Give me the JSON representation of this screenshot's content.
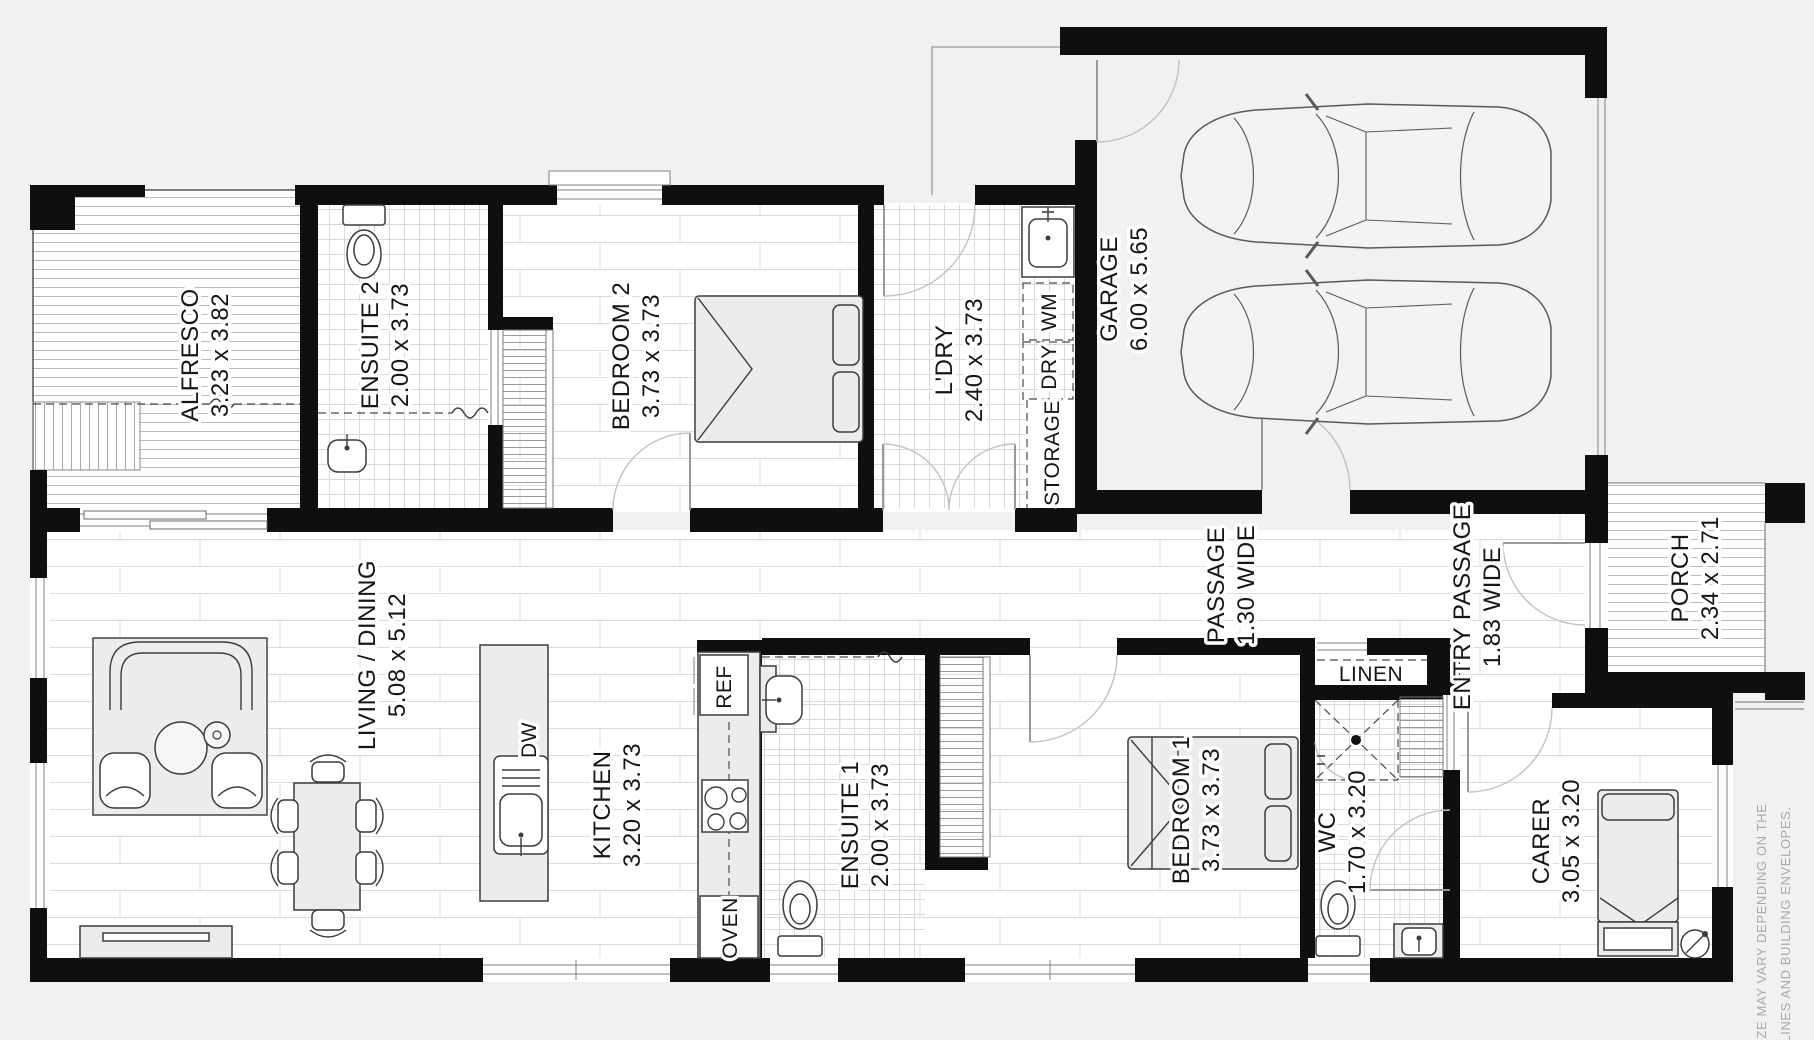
{
  "plan_title": "single storey house floor plan",
  "rooms": {
    "alfresco": {
      "name": "ALFRESCO",
      "dims": "3.23 x 3.82"
    },
    "ensuite2": {
      "name": "ENSUITE 2",
      "dims": "2.00 x 3.73"
    },
    "bedroom2": {
      "name": "BEDROOM 2",
      "dims": "3.73 x 3.73"
    },
    "ldry": {
      "name": "L'DRY",
      "dims": "2.40 x 3.73"
    },
    "garage": {
      "name": "GARAGE",
      "dims": "6.00 x 5.65"
    },
    "living": {
      "name": "LIVING / DINING",
      "dims": "5.08 x 5.12"
    },
    "kitchen": {
      "name": "KITCHEN",
      "dims": "3.20 x 3.73"
    },
    "ensuite1": {
      "name": "ENSUITE 1",
      "dims": "2.00 x 3.73"
    },
    "bedroom1": {
      "name": "BEDROOM 1",
      "dims": "3.73 x 3.73"
    },
    "passage": {
      "name": "PASSAGE",
      "dims": "1.30 WIDE"
    },
    "entry": {
      "name": "ENTRY PASSAGE",
      "dims": "1.83 WIDE"
    },
    "porch": {
      "name": "PORCH",
      "dims": "2.34 x 2.71"
    },
    "wc": {
      "name": "WC",
      "dims": "1.70 x 3.20"
    },
    "carer": {
      "name": "CARER",
      "dims": "3.05 x 3.20"
    }
  },
  "closets": {
    "linen": "LINEN",
    "storage": "STORAGE"
  },
  "appliances": {
    "wm": "WM",
    "dry": "DRY",
    "ref": "REF",
    "dw": "DW",
    "oven": "OVEN"
  },
  "disclaimer": {
    "line1": "SIZE MAY VARY DEPENDING ON THE",
    "line2": "ELINES AND BUILDING ENVELOPES."
  },
  "colors": {
    "wall": "#0f0f0f",
    "background": "#f1f1f0",
    "floor": "#ffffff",
    "furniture": "#ececeb"
  }
}
